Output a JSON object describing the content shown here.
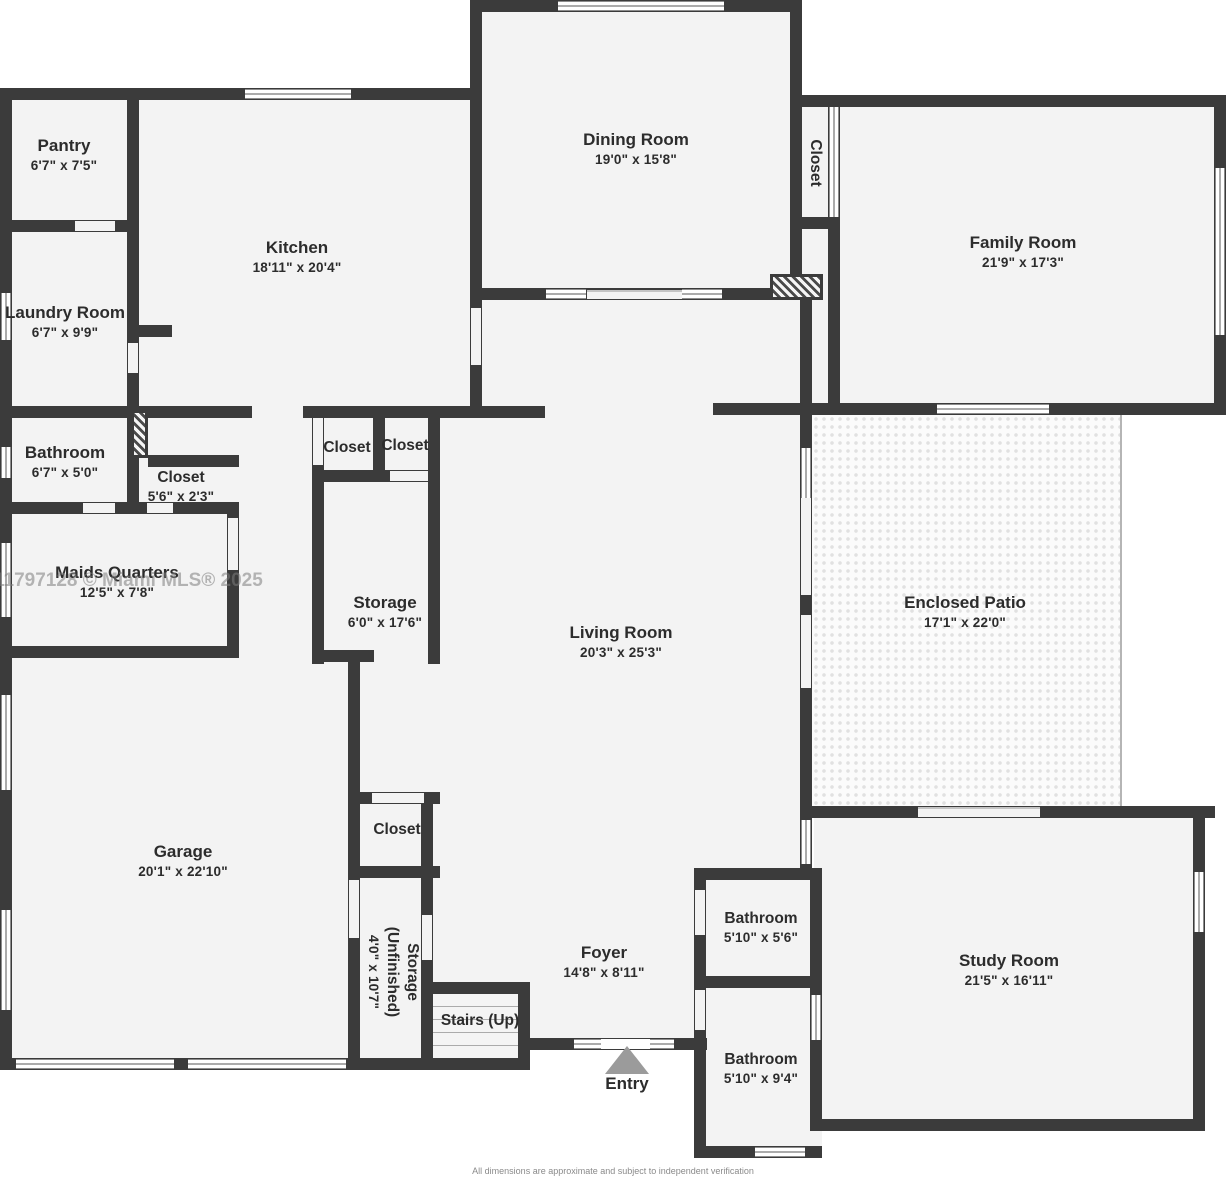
{
  "meta": {
    "watermark": "11797128 © Miami MLS® 2025",
    "disclaimer": "All dimensions are approximate and subject to independent verification"
  },
  "colors": {
    "wall": "#3b3b3b",
    "room_fill": "#f3f3f3",
    "background": "#ffffff",
    "label_text": "#2c2c2c",
    "entry_arrow": "#9b9b9b",
    "watermark_gray": "#7e7e7e"
  },
  "rooms": {
    "pantry": {
      "label": "Pantry",
      "dims": "6'7\" x 7'5\""
    },
    "kitchen": {
      "label": "Kitchen",
      "dims": "18'11\" x 20'4\""
    },
    "dining": {
      "label": "Dining Room",
      "dims": "19'0\" x 15'8\""
    },
    "dining_closet": {
      "label": "Closet"
    },
    "family": {
      "label": "Family Room",
      "dims": "21'9\" x 17'3\""
    },
    "laundry": {
      "label": "Laundry Room",
      "dims": "6'7\" x 9'9\""
    },
    "bathroom_left": {
      "label": "Bathroom",
      "dims": "6'7\" x 5'0\""
    },
    "closet_hall": {
      "label": "Closet",
      "dims": "5'6\" x 2'3\""
    },
    "maids": {
      "label": "Maids Quarters",
      "dims": "12'5\" x 7'8\""
    },
    "closet_a": {
      "label": "Closet"
    },
    "closet_b": {
      "label": "Closet"
    },
    "storage": {
      "label": "Storage",
      "dims": "6'0\" x 17'6\""
    },
    "living": {
      "label": "Living Room",
      "dims": "20'3\" x 25'3\""
    },
    "patio": {
      "label": "Enclosed Patio",
      "dims": "17'1\" x 22'0\""
    },
    "garage": {
      "label": "Garage",
      "dims": "20'1\" x 22'10\""
    },
    "closet_garage": {
      "label": "Closet"
    },
    "storage_unfinished": {
      "label": "Storage",
      "label2": "(Unfinished)",
      "dims": "4'0\" x 10'7\""
    },
    "stairs": {
      "label": "Stairs (Up)"
    },
    "foyer": {
      "label": "Foyer",
      "dims": "14'8\" x 8'11\""
    },
    "entry": {
      "label": "Entry"
    },
    "bathroom_1": {
      "label": "Bathroom",
      "dims": "5'10\" x 5'6\""
    },
    "bathroom_2": {
      "label": "Bathroom",
      "dims": "5'10\" x 9'4\""
    },
    "study": {
      "label": "Study Room",
      "dims": "21'5\" x 16'11\""
    }
  }
}
